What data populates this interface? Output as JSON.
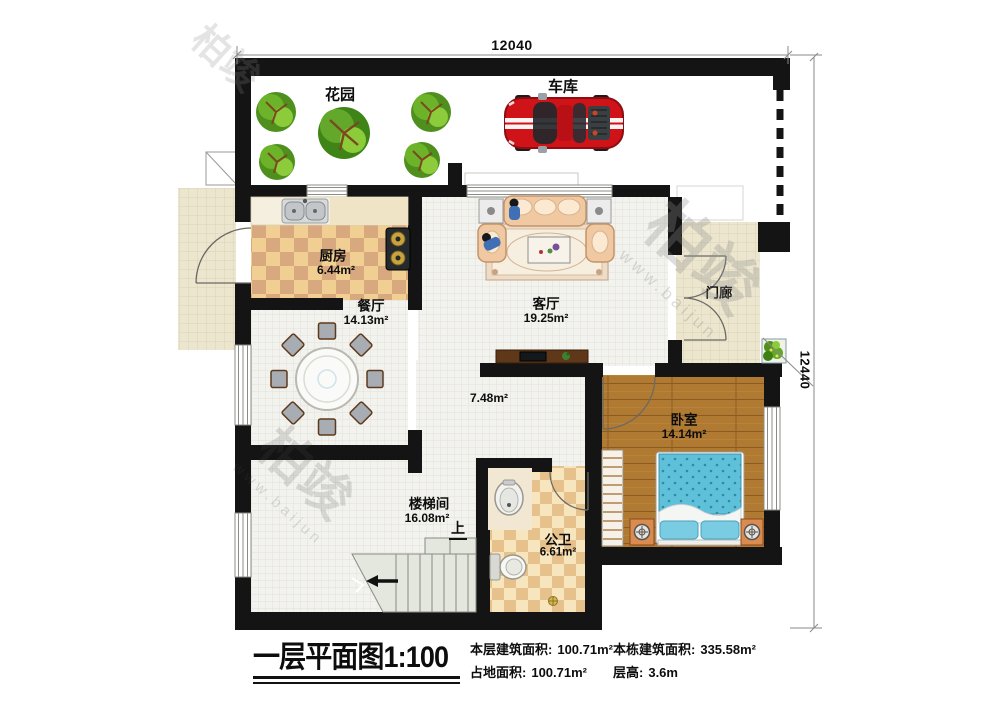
{
  "dimensions": {
    "top": "12040",
    "right": "12440"
  },
  "rooms": {
    "garden": {
      "label": "花园"
    },
    "garage": {
      "label": "车库"
    },
    "kitchen": {
      "label": "厨房",
      "area": "6.44m²"
    },
    "dining": {
      "label": "餐厅",
      "area": "14.13m²"
    },
    "living": {
      "label": "客厅",
      "area": "19.25m²"
    },
    "porch": {
      "label": "门廊"
    },
    "hallway": {
      "area": "7.48m²"
    },
    "bedroom": {
      "label": "卧室",
      "area": "14.14m²"
    },
    "stairwell": {
      "label": "楼梯间",
      "area": "16.08m²",
      "up": "上"
    },
    "bathroom": {
      "label": "公卫",
      "area": "6.61m²"
    }
  },
  "title": {
    "name": "一层平面图",
    "scale": "1:100"
  },
  "info": {
    "floor_area_label": "本层建筑面积:",
    "floor_area_value": "100.71m²",
    "land_area_label": "占地面积:",
    "land_area_value": "100.71m²",
    "building_area_label": "本栋建筑面积:",
    "building_area_value": "335.58m²",
    "floor_height_label": "层高:",
    "floor_height_value": "3.6m"
  },
  "watermark": {
    "brand": "柏竣",
    "site": "www.baijun"
  },
  "colors": {
    "wall": "#141414",
    "kitchen_tile_light": "#f1cf92",
    "kitchen_tile_dark": "#d8a87e",
    "bath_tile_light": "#f7e6bd",
    "bath_tile_dark": "#e6c18b",
    "wood_floor": "#b07a33",
    "bed_blue": "#5fc0da",
    "car_red": "#cf1318",
    "tree_green": "#5aa11e",
    "porch_tile": "#ece6cf"
  }
}
